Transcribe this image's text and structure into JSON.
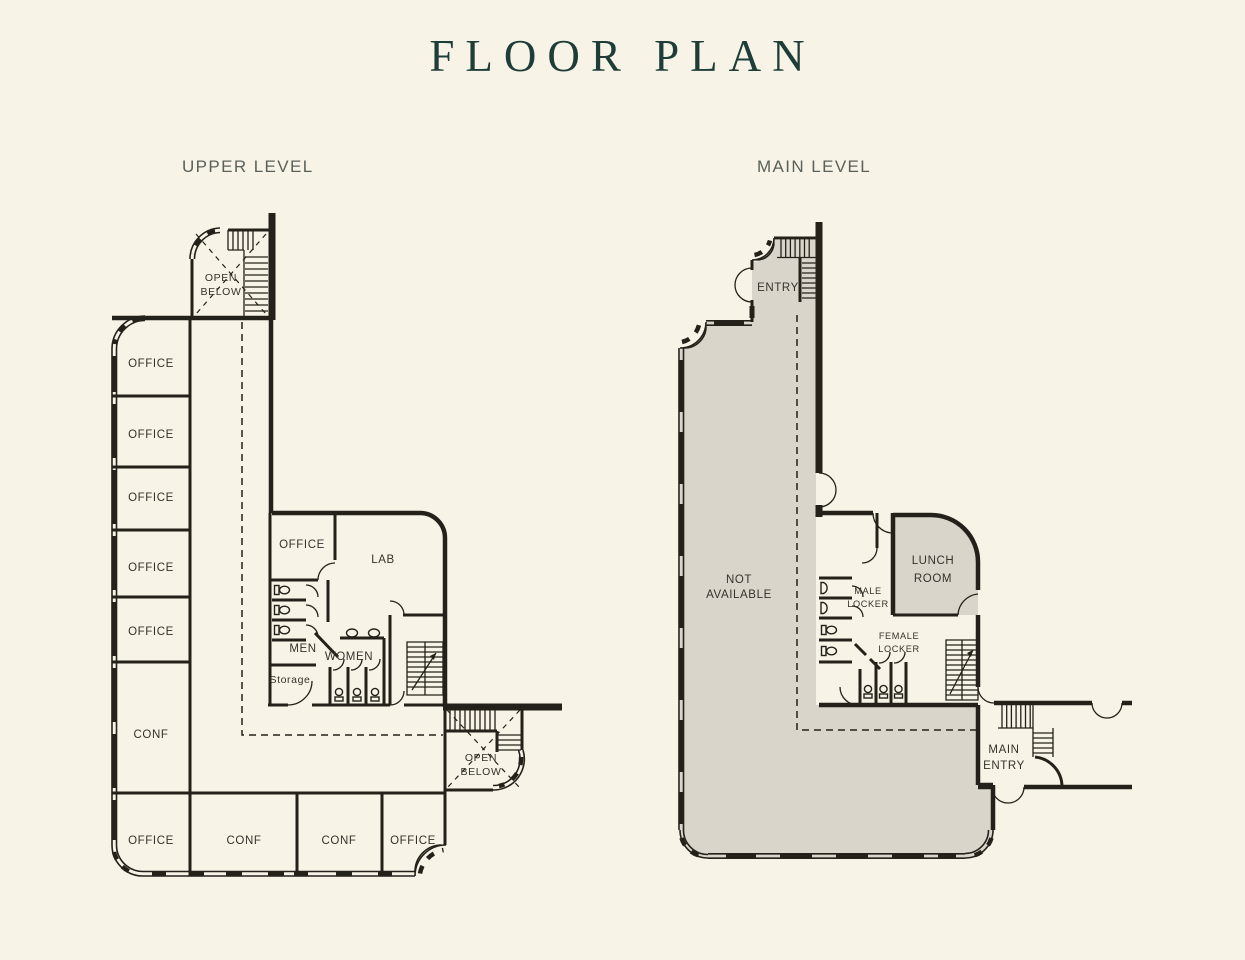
{
  "title": "FLOOR PLAN",
  "colors": {
    "background": "#f7f3e6",
    "ink": "#24211b",
    "gray_fill": "#d9d5cb",
    "title_color": "#1e3d38",
    "level_label_color": "#5a615b",
    "room_label_color": "#35322c"
  },
  "plans": {
    "upper": {
      "name": "UPPER LEVEL",
      "rooms": {
        "open_below_top": [
          "OPEN",
          "BELOW"
        ],
        "offices_left": [
          "OFFICE",
          "OFFICE",
          "OFFICE",
          "OFFICE",
          "OFFICE"
        ],
        "conf_left": "CONF",
        "office_mid": "OFFICE",
        "lab": "LAB",
        "men": "MEN",
        "women": "WOMEN",
        "storage": "Storage",
        "open_below_bottom": [
          "OPEN",
          "BELOW"
        ],
        "bottom_row": [
          "OFFICE",
          "CONF",
          "CONF",
          "OFFICE"
        ]
      }
    },
    "main": {
      "name": "MAIN LEVEL",
      "rooms": {
        "entry": "ENTRY",
        "not_available": [
          "NOT",
          "AVAILABLE"
        ],
        "lunch_room": [
          "LUNCH",
          "ROOM"
        ],
        "male_locker": [
          "MALE",
          "LOCKER"
        ],
        "female_locker": [
          "FEMALE",
          "LOCKER"
        ],
        "main_entry": [
          "MAIN",
          "ENTRY"
        ]
      }
    }
  }
}
